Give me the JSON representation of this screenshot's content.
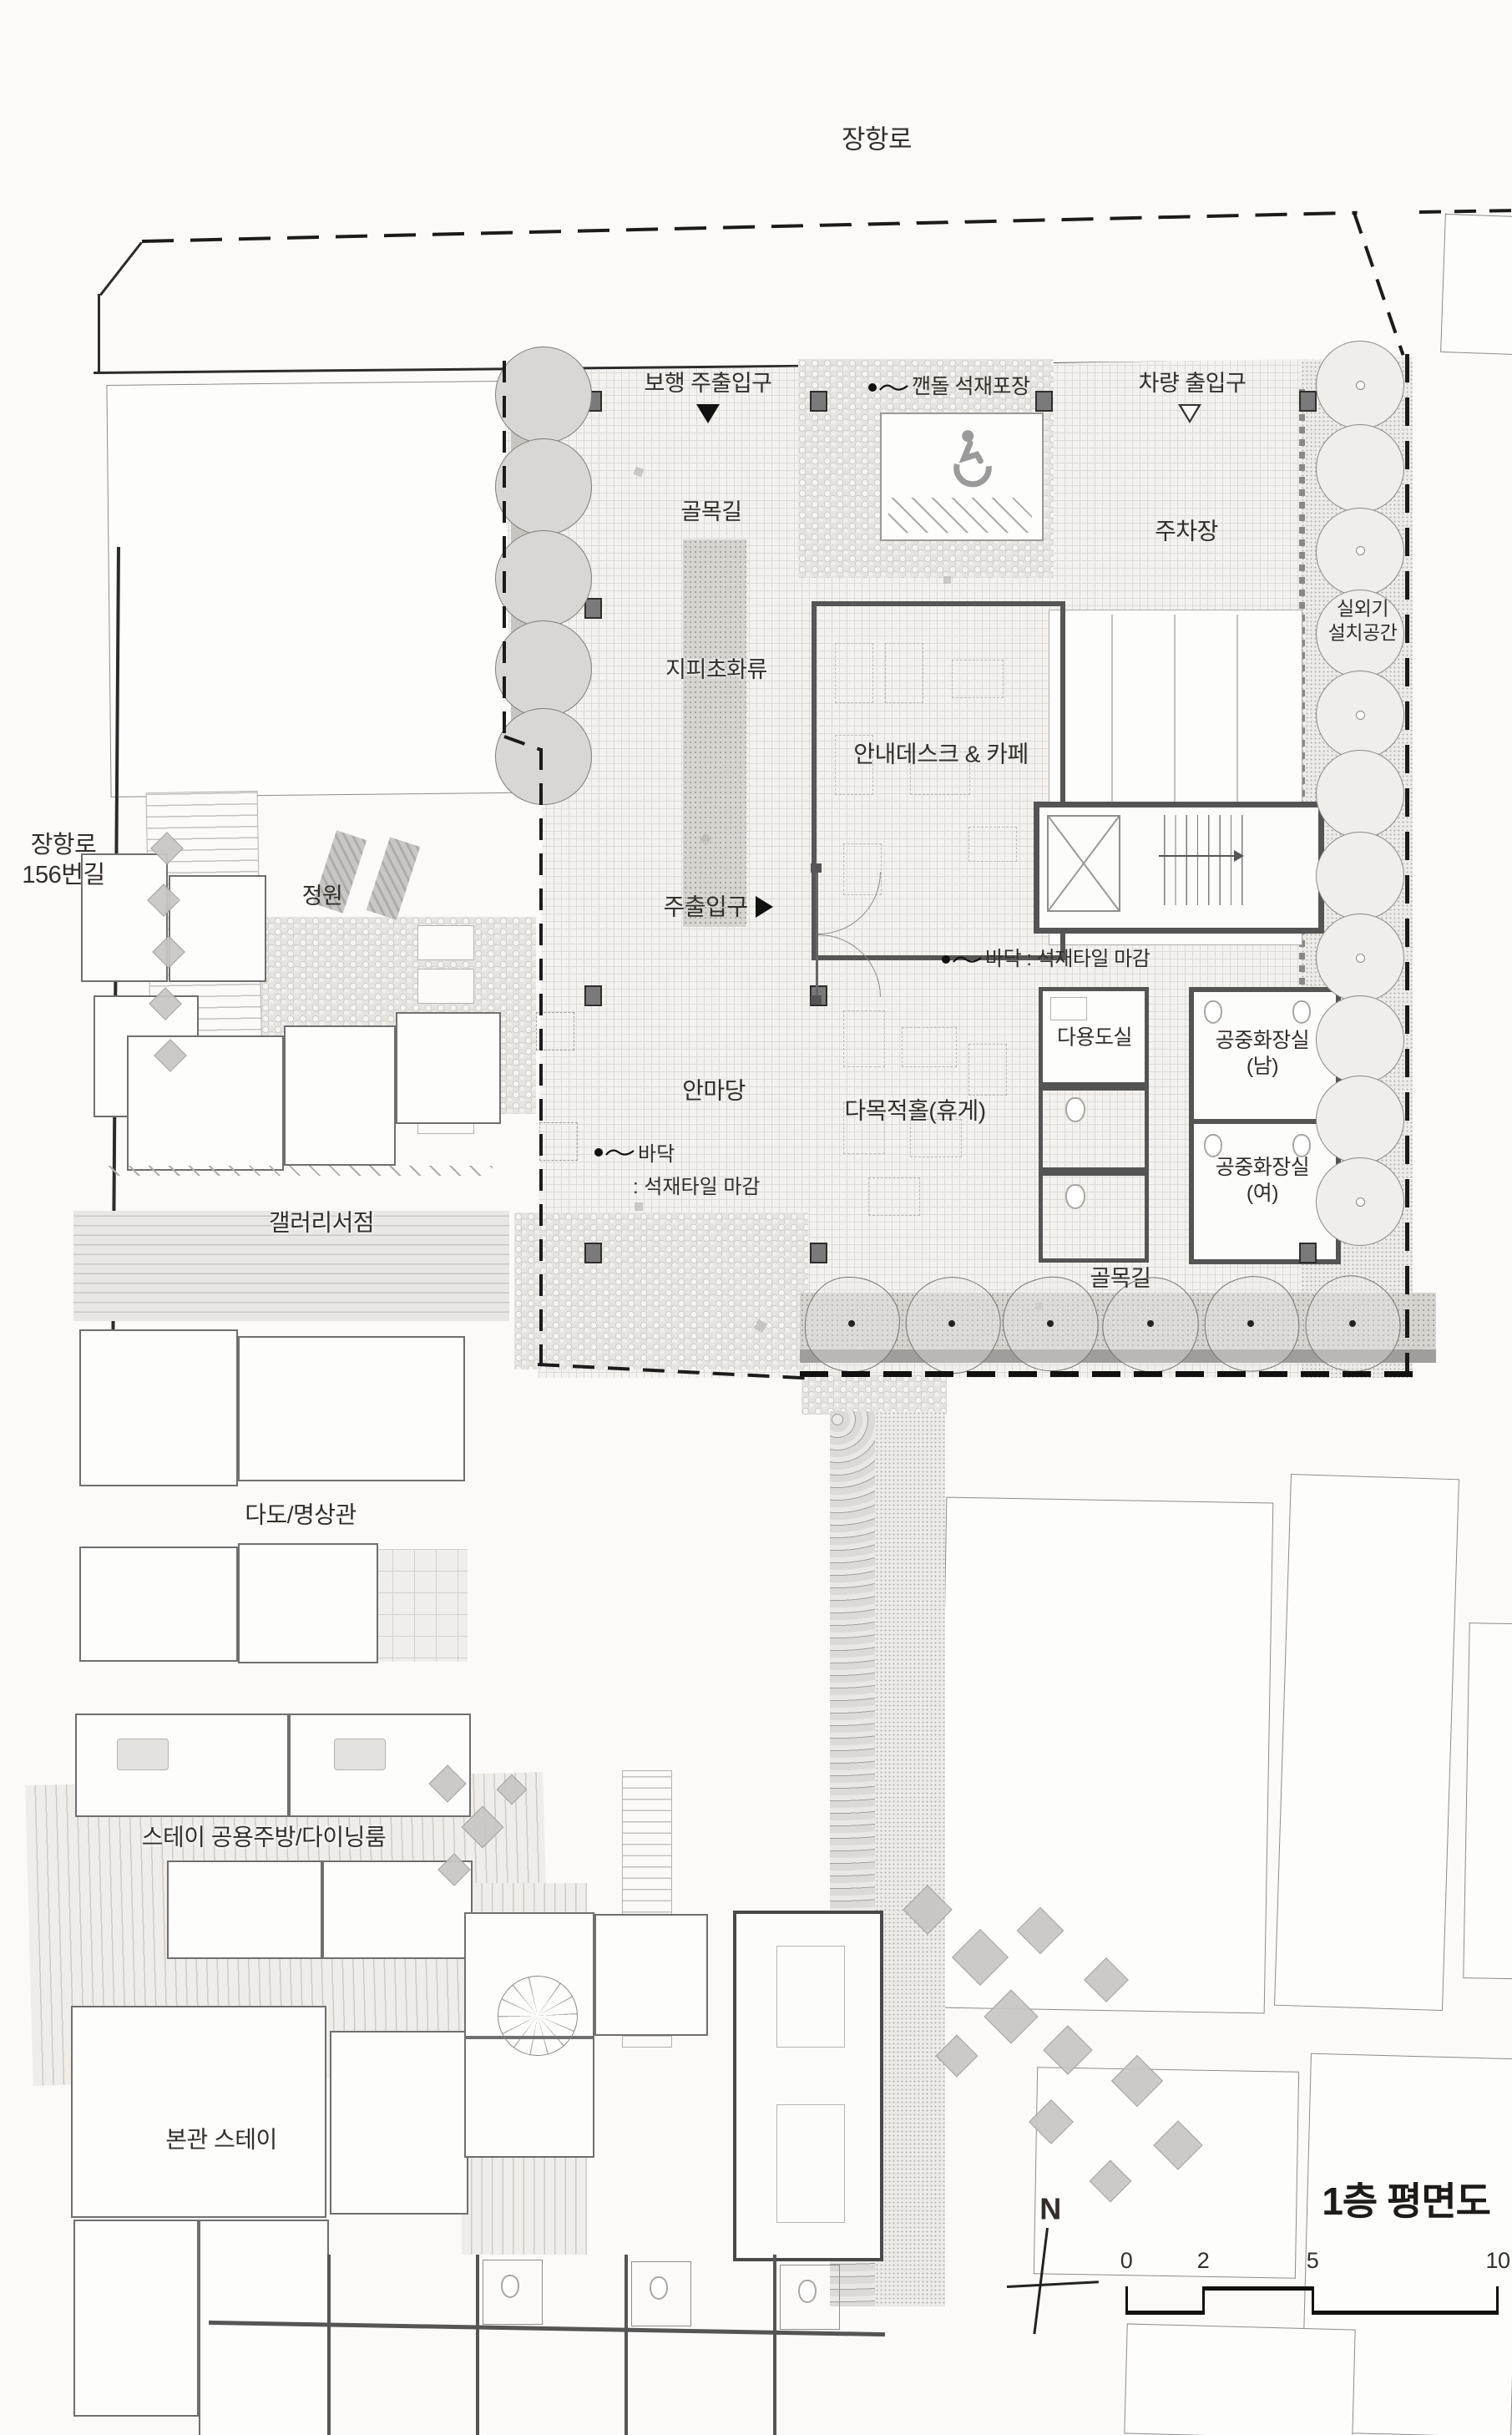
{
  "colors": {
    "wall": "#565656",
    "boundary": "#1b1b1b",
    "text": "#332e29",
    "tree_fill": "#d9d7d3",
    "paper": "#fbfaf8"
  },
  "roads": {
    "top": "장항로",
    "left_line1": "장항로",
    "left_line2": "156번길"
  },
  "site": {
    "pedestrian_entrance": "보행 주출입구",
    "stone_paving": "깬돌 석재포장",
    "vehicle_entrance": "차량 출입구",
    "alley_top": "골목길",
    "parking": "주차장",
    "groundcover": "지피초화류",
    "info_desk_cafe": "안내데스크 & 카페",
    "outdoor_unit_line1": "실외기",
    "outdoor_unit_line2": "설치공간",
    "garden": "정원",
    "main_entrance": "주출입구",
    "floor_finish": "바닥 : 석재타일 마감",
    "floor_finish_line1": "바닥",
    "floor_finish_line2": ": 석재타일 마감",
    "utility_room": "다용도실",
    "public_wc": "공중화장실",
    "wc_men_suffix": "(남)",
    "wc_women_suffix": "(여)",
    "courtyard": "안마당",
    "multipurpose_hall": "다목적홀(휴게)",
    "alley_bottom": "골목길"
  },
  "village": {
    "gallery_bookstore": "갤러리서점",
    "tea_meditation": "다도/명상관",
    "stay_kitchen": "스테이 공용주방/다이닝룸",
    "main_stay": "본관 스테이"
  },
  "titleblock": {
    "plan_title": "1층 평면도",
    "north": "N",
    "scale_ticks": [
      "0",
      "2",
      "5",
      "10"
    ]
  }
}
